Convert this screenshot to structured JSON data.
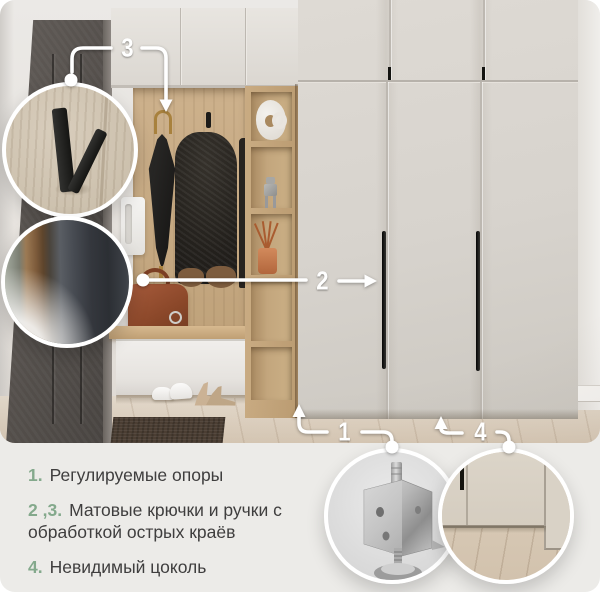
{
  "callouts": {
    "n1": "1",
    "n2": "2",
    "n3": "3",
    "n4": "4"
  },
  "legend": {
    "items": [
      {
        "num": "1.",
        "text": "Регулируемые опоры"
      },
      {
        "num": "2 ,3.",
        "text": "Матовые крючки и ручки с обработкой острых краёв"
      },
      {
        "num": "4.",
        "text": "Невидимый цоколь"
      }
    ]
  },
  "colors": {
    "accent_green": "#84a98c",
    "legend_text": "#3f3e3e",
    "callout_white": "#ffffff",
    "canvas_bg": "#ecebe8",
    "wardrobe_door": "#d7d3cd",
    "oak_wood": "#c9ac86",
    "entrance_door": "#56514d",
    "handle_black": "#1d1d1b"
  },
  "insets": {
    "hook": "matte-hook-closeup",
    "handle": "matte-handle-closeup",
    "foot": "adjustable-foot-closeup",
    "plinth": "hidden-plinth-closeup"
  }
}
